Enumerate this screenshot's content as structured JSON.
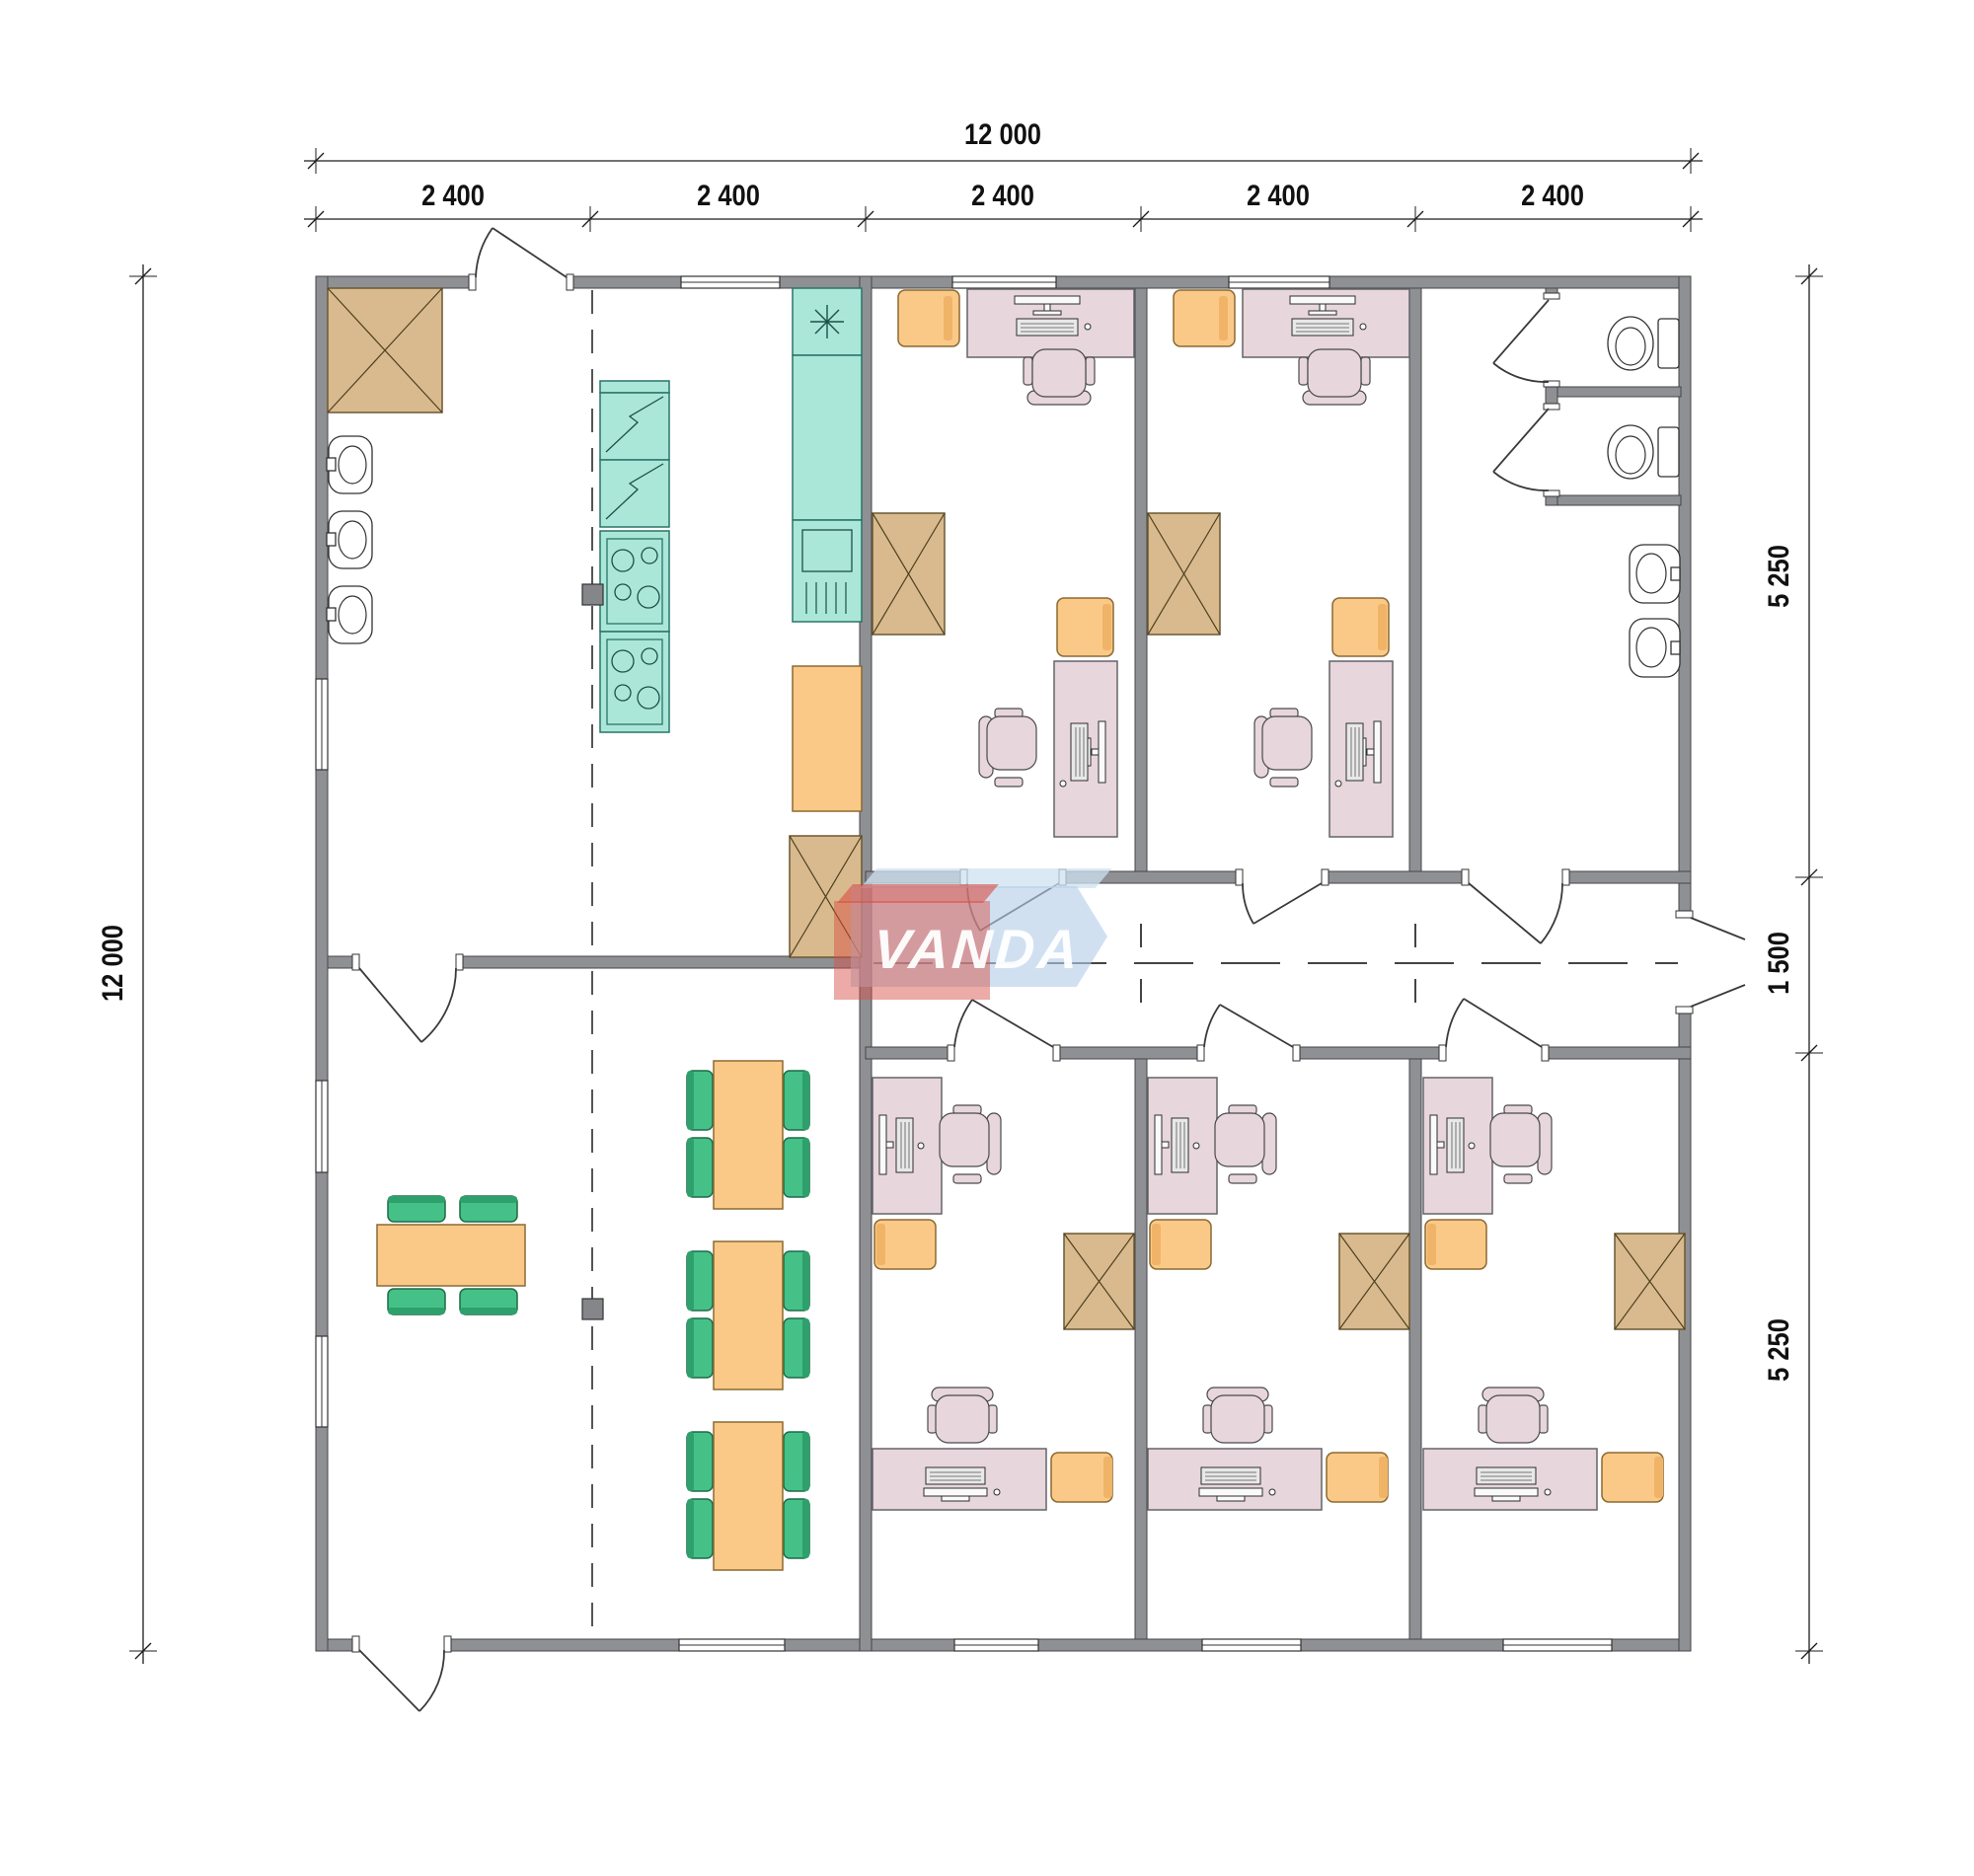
{
  "watermark": {
    "text": "VANDA"
  },
  "dimensions": {
    "top_total": "12 000",
    "left_total": "12 000",
    "top_bays": [
      "2 400",
      "2 400",
      "2 400",
      "2 400",
      "2 400"
    ],
    "right_segments": [
      "5 250",
      "1 500",
      "5 250"
    ]
  },
  "colors": {
    "wall": "#8f9094",
    "cabinet": "#d8ba8e",
    "kitchen_teal": "#abe7d9",
    "furniture_orange": "#fbc987",
    "chair_green": "#45c187",
    "desk_pink": "#e7d6db",
    "logo_red": "#d85045",
    "logo_blue": "#b5cde8"
  }
}
